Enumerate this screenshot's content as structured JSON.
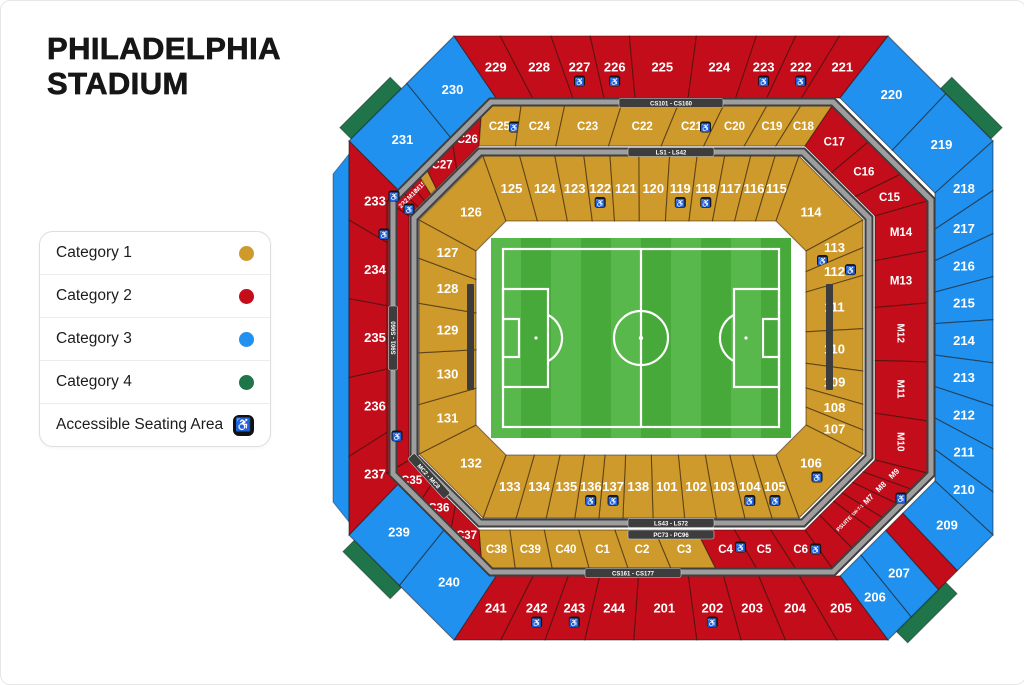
{
  "title": {
    "line1": "PHILADELPHIA",
    "line2": "STADIUM"
  },
  "legend": {
    "items": [
      {
        "label": "Category 1",
        "cat": 1
      },
      {
        "label": "Category 2",
        "cat": 2
      },
      {
        "label": "Category 3",
        "cat": 3
      },
      {
        "label": "Category 4",
        "cat": 4
      },
      {
        "label": "Accessible Seating Area",
        "accessible": true
      }
    ]
  },
  "icons": {
    "wheelchair": "♿"
  },
  "colors": {
    "cat1": "#CE9A2C",
    "cat2": "#C30D1B",
    "cat3": "#2091EE",
    "cat4": "#1F7549",
    "walk_dark": "#3F3F3F",
    "walk_light": "#9E9E9E",
    "chip_bg": "#3D3D3D",
    "chip_text": "#FFFFFF",
    "field_light": "#58B84B",
    "field_dark": "#47A93A",
    "field_line": "#FFFFFF",
    "bar": "#3C3C3C",
    "label": "#FFFFFF"
  },
  "bands": {
    "top_outer": "CS101 - CS160",
    "top_inner": "LS1 - LS42",
    "bottom_inner_1": "LS43 - LS72",
    "bottom_inner_2": "PC73 - PC96",
    "bottom_outer": "CS161 - CS177",
    "left_vertical": "S901 - S960",
    "bottom_left": "MC2 - MC8"
  },
  "stadium": {
    "rings": {
      "outer": {
        "tl": [
          {
            "label": "231",
            "cat": 3,
            "w": 0.55
          },
          {
            "label": "230",
            "cat": 3,
            "w": 0.45
          }
        ],
        "top": [
          {
            "label": "229",
            "cat": 2,
            "w": 1.0
          },
          {
            "label": "228",
            "cat": 2,
            "w": 1.1
          },
          {
            "label": "227",
            "cat": 2,
            "w": 0.85,
            "acc": true
          },
          {
            "label": "226",
            "cat": 2,
            "w": 0.85,
            "acc": true
          },
          {
            "label": "225",
            "cat": 2,
            "w": 1.45
          },
          {
            "label": "224",
            "cat": 2,
            "w": 1.3
          },
          {
            "label": "223",
            "cat": 2,
            "w": 0.85,
            "acc": true
          },
          {
            "label": "222",
            "cat": 2,
            "w": 0.95,
            "acc": true
          },
          {
            "label": "221",
            "cat": 2,
            "w": 1.05
          }
        ],
        "tr": [
          {
            "label": "220",
            "cat": 3,
            "w": 0.55
          },
          {
            "label": "219",
            "cat": 3,
            "w": 0.45
          }
        ],
        "right": [
          {
            "label": "218",
            "cat": 3,
            "w": 1.15
          },
          {
            "label": "217",
            "cat": 3,
            "w": 1
          },
          {
            "label": "216",
            "cat": 3,
            "w": 1
          },
          {
            "label": "215",
            "cat": 3,
            "w": 1
          },
          {
            "label": "214",
            "cat": 3,
            "w": 1
          },
          {
            "label": "213",
            "cat": 3,
            "w": 1
          },
          {
            "label": "212",
            "cat": 3,
            "w": 1
          },
          {
            "label": "211",
            "cat": 3,
            "w": 1
          },
          {
            "label": "210",
            "cat": 3,
            "w": 1
          }
        ],
        "br": [
          {
            "label": "209",
            "cat": 3,
            "w": 0.34
          },
          {
            "label": "",
            "cat": 2,
            "w": 0.18
          },
          {
            "label": "207",
            "cat": 3,
            "w": 0.26
          },
          {
            "label": "206",
            "cat": 3,
            "w": 0.22
          }
        ],
        "bottom": [
          {
            "label": "205",
            "cat": 2,
            "w": 1.1
          },
          {
            "label": "204",
            "cat": 2,
            "w": 1.1
          },
          {
            "label": "203",
            "cat": 2,
            "w": 0.95
          },
          {
            "label": "202",
            "cat": 2,
            "w": 0.95,
            "acc": true
          },
          {
            "label": "201",
            "cat": 2,
            "w": 1.35
          },
          {
            "label": "244",
            "cat": 2,
            "w": 1.05
          },
          {
            "label": "243",
            "cat": 2,
            "w": 0.85,
            "acc": true
          },
          {
            "label": "242",
            "cat": 2,
            "w": 0.95,
            "acc": true
          },
          {
            "label": "241",
            "cat": 2,
            "w": 1.0
          }
        ],
        "bl": [
          {
            "label": "240",
            "cat": 3,
            "w": 0.52
          },
          {
            "label": "239",
            "cat": 3,
            "w": 0.48
          }
        ],
        "left": [
          {
            "label": "237",
            "cat": 2,
            "w": 1
          },
          {
            "label": "236",
            "cat": 2,
            "w": 1
          },
          {
            "label": "235",
            "cat": 2,
            "w": 1,
            "acc": true,
            "off": [
              17,
              2
            ]
          },
          {
            "label": "234",
            "cat": 2,
            "w": 1
          },
          {
            "label": "233",
            "cat": 2,
            "w": 1
          }
        ]
      },
      "middle": {
        "tl": [
          {
            "label": "232",
            "cat": 2,
            "w": 0.13,
            "rot": -45,
            "fs": 6.5
          },
          {
            "label": "M16",
            "cat": 2,
            "w": 0.09,
            "rot": -45,
            "fs": 6.5
          },
          {
            "label": "M15",
            "cat": 2,
            "w": 0.09,
            "rot": -45,
            "fs": 6.5
          },
          {
            "label": "",
            "cat": 1,
            "w": 0.08
          },
          {
            "label": "C27",
            "cat": 2,
            "w": 0.29
          },
          {
            "label": "C26",
            "cat": 2,
            "w": 0.32
          }
        ],
        "top": [
          {
            "label": "C25",
            "cat": 1,
            "w": 0.9,
            "acc": true,
            "off": [
              15,
              1
            ]
          },
          {
            "label": "C24",
            "cat": 1,
            "w": 1.0
          },
          {
            "label": "C23",
            "cat": 1,
            "w": 1.3
          },
          {
            "label": "C22",
            "cat": 1,
            "w": 1.3
          },
          {
            "label": "C21",
            "cat": 1,
            "w": 1.05,
            "acc": true,
            "off": [
              14,
              1
            ]
          },
          {
            "label": "C20",
            "cat": 1,
            "w": 1.0
          },
          {
            "label": "C19",
            "cat": 1,
            "w": 0.78
          },
          {
            "label": "C18",
            "cat": 1,
            "w": 0.72
          }
        ],
        "tr": [
          {
            "label": "C17",
            "cat": 2,
            "w": 0.38
          },
          {
            "label": "C16",
            "cat": 2,
            "w": 0.34
          },
          {
            "label": "C15",
            "cat": 2,
            "w": 0.28
          }
        ],
        "right": [
          {
            "label": "M14",
            "cat": 2,
            "w": 1.1
          },
          {
            "label": "M13",
            "cat": 2,
            "w": 1.15
          },
          {
            "label": "M12",
            "cat": 2,
            "w": 1.3,
            "rot": 90,
            "fs": 10
          },
          {
            "label": "M11",
            "cat": 2,
            "w": 1.3,
            "rot": 90,
            "fs": 10
          },
          {
            "label": "M10",
            "cat": 2,
            "w": 1.15,
            "rot": 90,
            "fs": 10
          }
        ],
        "br": [
          {
            "label": "M9",
            "cat": 2,
            "w": 0.17,
            "rot": -45,
            "fs": 8
          },
          {
            "label": "M8",
            "cat": 2,
            "w": 0.15,
            "rot": -45,
            "fs": 8
          },
          {
            "label": "M7",
            "cat": 2,
            "w": 0.15,
            "rot": -45,
            "fs": 8
          },
          {
            "label": "SW-T-1",
            "cat": 2,
            "w": 0.12,
            "rot": -45,
            "fs": 4.5
          },
          {
            "label": "PSUITE",
            "cat": 2,
            "w": 0.2,
            "rot": -45,
            "fs": 5.5
          },
          {
            "label": "",
            "cat": 2,
            "w": 0.21
          }
        ],
        "bottom": [
          {
            "label": "C6",
            "cat": 2,
            "w": 0.95,
            "acc": true,
            "off": [
              15,
              0
            ]
          },
          {
            "label": "C5",
            "cat": 2,
            "w": 1.0
          },
          {
            "label": "C4",
            "cat": 2,
            "w": 1.05,
            "acc": true,
            "off": [
              15,
              -2
            ]
          },
          {
            "label": "C3",
            "cat": 1,
            "w": 1.15
          },
          {
            "label": "C2",
            "cat": 1,
            "w": 1.1
          },
          {
            "label": "C1",
            "cat": 1,
            "w": 1.0
          },
          {
            "label": "C40",
            "cat": 1,
            "w": 0.95
          },
          {
            "label": "C39",
            "cat": 1,
            "w": 0.95
          },
          {
            "label": "C38",
            "cat": 1,
            "w": 0.85
          }
        ],
        "bl": [
          {
            "label": "C37",
            "cat": 2,
            "w": 0.34
          },
          {
            "label": "C36",
            "cat": 2,
            "w": 0.33
          },
          {
            "label": "C35",
            "cat": 2,
            "w": 0.33
          }
        ],
        "left": [
          {
            "label": "",
            "cat": 2,
            "w": 1
          }
        ]
      },
      "inner": {
        "tl": [
          {
            "label": "126",
            "cat": 1,
            "w": 1
          }
        ],
        "top": [
          {
            "label": "125",
            "cat": 1,
            "w": 1.2
          },
          {
            "label": "124",
            "cat": 1,
            "w": 1.15
          },
          {
            "label": "123",
            "cat": 1,
            "w": 0.95
          },
          {
            "label": "122",
            "cat": 1,
            "w": 0.85,
            "acc": true
          },
          {
            "label": "121",
            "cat": 1,
            "w": 0.95
          },
          {
            "label": "120",
            "cat": 1,
            "w": 1.0
          },
          {
            "label": "119",
            "cat": 1,
            "w": 0.9,
            "acc": true
          },
          {
            "label": "118",
            "cat": 1,
            "w": 0.9,
            "acc": true
          },
          {
            "label": "117",
            "cat": 1,
            "w": 0.85
          },
          {
            "label": "116",
            "cat": 1,
            "w": 0.8
          },
          {
            "label": "115",
            "cat": 1,
            "w": 0.78
          }
        ],
        "tr": [
          {
            "label": "114",
            "cat": 1,
            "w": 1
          }
        ],
        "right": [
          {
            "label": "113",
            "cat": 1,
            "w": 0.75,
            "acc": true,
            "off": [
              -12,
              13
            ]
          },
          {
            "label": "112",
            "cat": 1,
            "w": 0.75,
            "acc": true,
            "off": [
              16,
              -2
            ]
          },
          {
            "label": "111",
            "cat": 1,
            "w": 1.45
          },
          {
            "label": "110",
            "cat": 1,
            "w": 1.15
          },
          {
            "label": "109",
            "cat": 1,
            "w": 0.9
          },
          {
            "label": "108",
            "cat": 1,
            "w": 0.7
          },
          {
            "label": "107",
            "cat": 1,
            "w": 0.65
          }
        ],
        "br": [
          {
            "label": "106",
            "cat": 1,
            "w": 1,
            "acc": true,
            "off": [
              6,
              14
            ]
          }
        ],
        "bottom": [
          {
            "label": "105",
            "cat": 1,
            "w": 0.9,
            "acc": true
          },
          {
            "label": "104",
            "cat": 1,
            "w": 0.9,
            "acc": true
          },
          {
            "label": "103",
            "cat": 1,
            "w": 0.95
          },
          {
            "label": "102",
            "cat": 1,
            "w": 1.05
          },
          {
            "label": "101",
            "cat": 1,
            "w": 1.05
          },
          {
            "label": "138",
            "cat": 1,
            "w": 1.0
          },
          {
            "label": "137",
            "cat": 1,
            "w": 0.8,
            "acc": true
          },
          {
            "label": "136",
            "cat": 1,
            "w": 0.8,
            "acc": true
          },
          {
            "label": "135",
            "cat": 1,
            "w": 0.95
          },
          {
            "label": "134",
            "cat": 1,
            "w": 1.0
          },
          {
            "label": "133",
            "cat": 1,
            "w": 1.1
          }
        ],
        "bl": [
          {
            "label": "132",
            "cat": 1,
            "w": 1
          }
        ],
        "left": [
          {
            "label": "131",
            "cat": 1,
            "w": 1.1
          },
          {
            "label": "130",
            "cat": 1,
            "w": 1.15
          },
          {
            "label": "129",
            "cat": 1,
            "w": 1.1
          },
          {
            "label": "128",
            "cat": 1,
            "w": 1.0
          },
          {
            "label": "127",
            "cat": 1,
            "w": 0.85
          }
        ]
      }
    }
  }
}
